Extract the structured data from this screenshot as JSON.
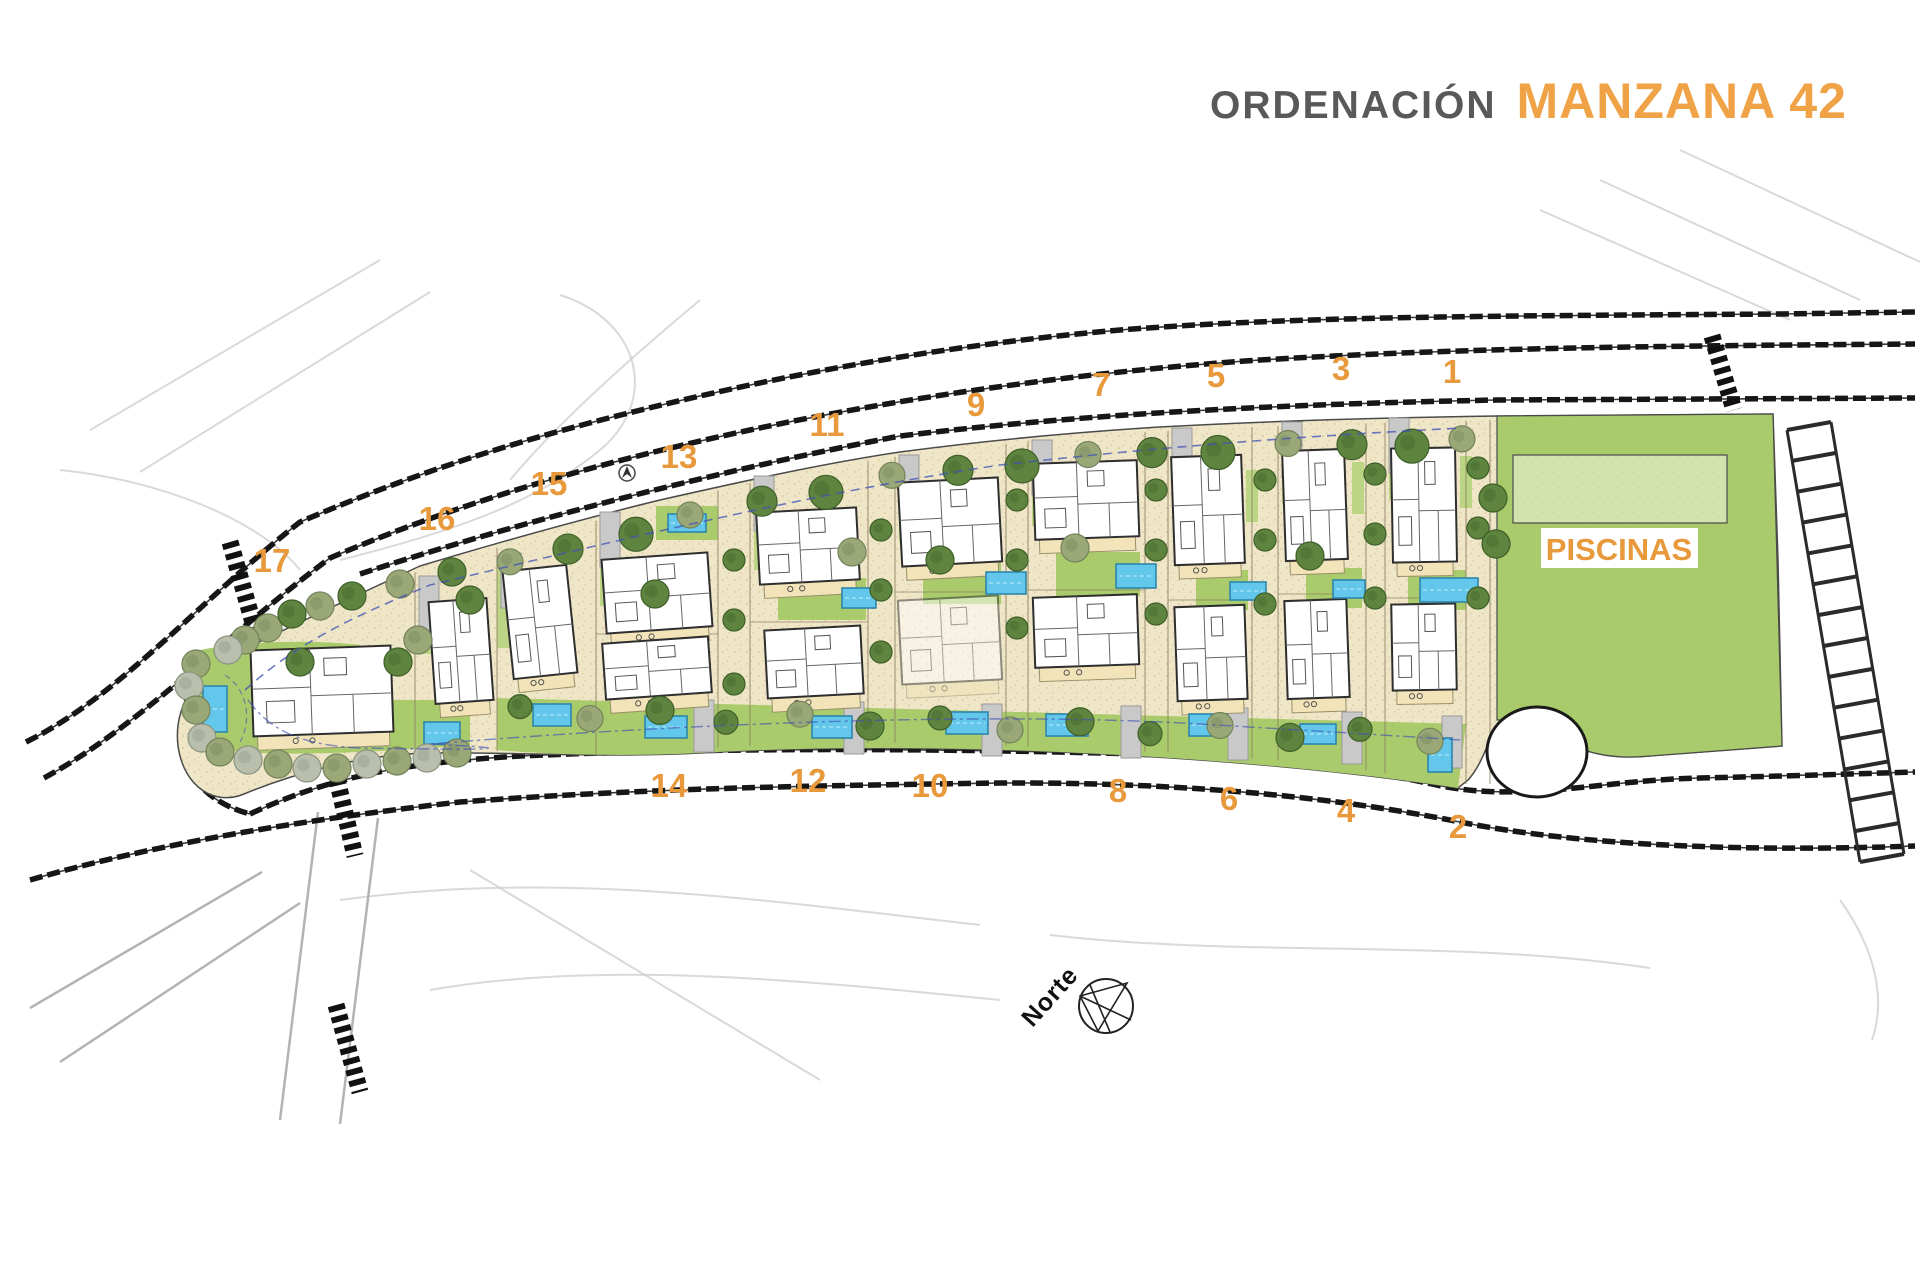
{
  "title": {
    "left": "ORDENACIÓN",
    "right": "MANZANA 42"
  },
  "labels": {
    "piscinas": "PISCINAS",
    "north": "Norte"
  },
  "colors": {
    "orange": "#E8993B",
    "title_gray": "#59595B",
    "road": "#161616",
    "sand": "#EFE6C8",
    "sand_dot": "#D6C498",
    "grass": "#A9CB6B",
    "grass_light": "#BCD584",
    "pool_water": "#63C7EC",
    "pool_border": "#2E86AB",
    "pool_lawn": "#D2E3AE",
    "tree_dark": "#5E8440",
    "tree_dark_edge": "#3E5F27",
    "tree_olive": "#9AA878",
    "tree_olive_edge": "#74835A",
    "tree_gray": "#B9BFAC",
    "tree_gray_edge": "#8C9480",
    "house_stroke": "#2E2E2E",
    "terrace": "#F2E4B8",
    "driveway": "#C9C9C9",
    "blue_line": "#3F51B5"
  },
  "plot_numbers": {
    "top": [
      {
        "n": "1",
        "x": 1452,
        "y": 383
      },
      {
        "n": "3",
        "x": 1341,
        "y": 380
      },
      {
        "n": "5",
        "x": 1216,
        "y": 387
      },
      {
        "n": "7",
        "x": 1101,
        "y": 396
      },
      {
        "n": "9",
        "x": 976,
        "y": 416
      },
      {
        "n": "11",
        "x": 827,
        "y": 436
      },
      {
        "n": "13",
        "x": 679,
        "y": 468
      },
      {
        "n": "15",
        "x": 549,
        "y": 495
      },
      {
        "n": "16",
        "x": 437,
        "y": 530
      },
      {
        "n": "17",
        "x": 272,
        "y": 572
      }
    ],
    "bottom": [
      {
        "n": "14",
        "x": 669,
        "y": 797
      },
      {
        "n": "12",
        "x": 808,
        "y": 792
      },
      {
        "n": "10",
        "x": 930,
        "y": 797
      },
      {
        "n": "8",
        "x": 1118,
        "y": 802
      },
      {
        "n": "6",
        "x": 1229,
        "y": 810
      },
      {
        "n": "4",
        "x": 1346,
        "y": 822
      },
      {
        "n": "2",
        "x": 1458,
        "y": 838
      }
    ]
  },
  "site": {
    "houses": [
      {
        "id": "17",
        "x": 252,
        "y": 648,
        "w": 140,
        "h": 86,
        "rot": -2,
        "op": 1
      },
      {
        "id": "16",
        "x": 432,
        "y": 600,
        "w": 58,
        "h": 102,
        "rot": -4,
        "op": 1
      },
      {
        "id": "15",
        "x": 508,
        "y": 568,
        "w": 64,
        "h": 108,
        "rot": -6,
        "op": 1
      },
      {
        "id": "13",
        "x": 604,
        "y": 556,
        "w": 106,
        "h": 74,
        "rot": -4,
        "op": 1
      },
      {
        "id": "14",
        "x": 604,
        "y": 640,
        "w": 106,
        "h": 56,
        "rot": -4,
        "op": 1
      },
      {
        "id": "11",
        "x": 758,
        "y": 510,
        "w": 100,
        "h": 72,
        "rot": -3,
        "op": 1
      },
      {
        "id": "12",
        "x": 766,
        "y": 628,
        "w": 96,
        "h": 68,
        "rot": -3,
        "op": 1
      },
      {
        "id": "9",
        "x": 900,
        "y": 480,
        "w": 100,
        "h": 84,
        "rot": -3,
        "op": 1
      },
      {
        "id": "10",
        "x": 900,
        "y": 598,
        "w": 100,
        "h": 84,
        "rot": -3,
        "op": 0.5
      },
      {
        "id": "7",
        "x": 1034,
        "y": 462,
        "w": 104,
        "h": 76,
        "rot": -2,
        "op": 1
      },
      {
        "id": "8",
        "x": 1034,
        "y": 596,
        "w": 104,
        "h": 70,
        "rot": -2,
        "op": 1
      },
      {
        "id": "5",
        "x": 1173,
        "y": 456,
        "w": 70,
        "h": 108,
        "rot": -2,
        "op": 1
      },
      {
        "id": "6",
        "x": 1176,
        "y": 606,
        "w": 70,
        "h": 94,
        "rot": -2,
        "op": 1
      },
      {
        "id": "3",
        "x": 1284,
        "y": 450,
        "w": 62,
        "h": 110,
        "rot": -2,
        "op": 1
      },
      {
        "id": "4",
        "x": 1286,
        "y": 600,
        "w": 62,
        "h": 98,
        "rot": -2,
        "op": 1
      },
      {
        "id": "1",
        "x": 1392,
        "y": 448,
        "w": 64,
        "h": 114,
        "rot": -1,
        "op": 1
      },
      {
        "id": "2",
        "x": 1392,
        "y": 604,
        "w": 64,
        "h": 86,
        "rot": -1,
        "op": 1
      }
    ],
    "pools": [
      {
        "id": "17",
        "x": 203,
        "y": 686,
        "w": 24,
        "h": 46
      },
      {
        "id": "16",
        "x": 424,
        "y": 722,
        "w": 36,
        "h": 22
      },
      {
        "id": "15",
        "x": 533,
        "y": 704,
        "w": 38,
        "h": 22
      },
      {
        "id": "13",
        "x": 668,
        "y": 514,
        "w": 38,
        "h": 18
      },
      {
        "id": "14",
        "x": 645,
        "y": 716,
        "w": 42,
        "h": 22
      },
      {
        "id": "11",
        "x": 842,
        "y": 588,
        "w": 34,
        "h": 20
      },
      {
        "id": "12",
        "x": 812,
        "y": 716,
        "w": 40,
        "h": 22
      },
      {
        "id": "9",
        "x": 986,
        "y": 572,
        "w": 40,
        "h": 22
      },
      {
        "id": "10",
        "x": 946,
        "y": 712,
        "w": 42,
        "h": 22
      },
      {
        "id": "7",
        "x": 1116,
        "y": 564,
        "w": 40,
        "h": 24
      },
      {
        "id": "8",
        "x": 1046,
        "y": 714,
        "w": 42,
        "h": 22
      },
      {
        "id": "5",
        "x": 1230,
        "y": 582,
        "w": 36,
        "h": 18
      },
      {
        "id": "6",
        "x": 1189,
        "y": 714,
        "w": 38,
        "h": 22
      },
      {
        "id": "3",
        "x": 1333,
        "y": 580,
        "w": 32,
        "h": 18
      },
      {
        "id": "4",
        "x": 1300,
        "y": 724,
        "w": 36,
        "h": 20
      },
      {
        "id": "1",
        "x": 1420,
        "y": 578,
        "w": 58,
        "h": 24
      },
      {
        "id": "2",
        "x": 1428,
        "y": 738,
        "w": 24,
        "h": 34
      }
    ],
    "piscinas_area": {
      "x": 1497,
      "y": 416,
      "w": 281,
      "h": 330,
      "lawn": {
        "x": 1513,
        "y": 455,
        "w": 214,
        "h": 68
      },
      "label_box": {
        "x": 1541,
        "y": 528,
        "w": 157,
        "h": 40
      }
    }
  }
}
